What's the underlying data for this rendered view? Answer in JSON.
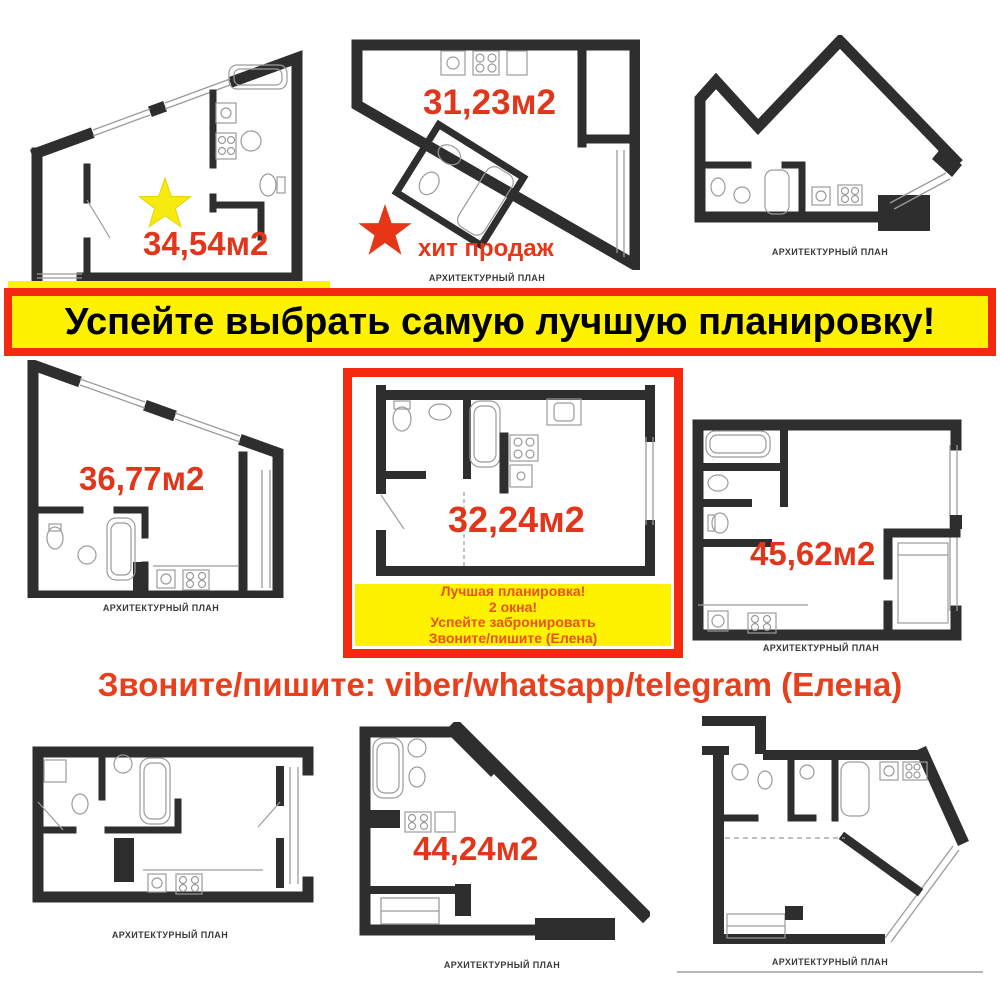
{
  "banner": {
    "text": "Успейте выбрать самую лучшую планировку!"
  },
  "contact": {
    "text": "Звоните/пишите: viber/whatsapp/telegram (Елена)"
  },
  "plans": [
    {
      "name": "top-left",
      "area": "34,54м2"
    },
    {
      "name": "top-middle",
      "area": "31,23м2",
      "badge": "хит продаж",
      "caption": "АРХИТЕКТУРНЫЙ ПЛАН"
    },
    {
      "name": "top-right",
      "caption": "АРХИТЕКТУРНЫЙ ПЛАН"
    },
    {
      "name": "middle-left",
      "area": "36,77м2",
      "caption": "АРХИТЕКТУРНЫЙ ПЛАН"
    },
    {
      "name": "middle-center",
      "area": "32,24м2",
      "promo": [
        "Лучшая планировка!",
        "2 окна!",
        "Успейте забронировать",
        "Звоните/пишите (Елена)"
      ]
    },
    {
      "name": "middle-right",
      "area": "45,62м2",
      "caption": "АРХИТЕКТУРНЫЙ ПЛАН"
    },
    {
      "name": "bottom-left",
      "caption": "АРХИТЕКТУРНЫЙ ПЛАН"
    },
    {
      "name": "bottom-middle",
      "area": "44,24м2",
      "caption": "АРХИТЕКТУРНЫЙ ПЛАН"
    },
    {
      "name": "bottom-right",
      "caption": "АРХИТЕКТУРНЫЙ ПЛАН"
    }
  ],
  "colors": {
    "accent_red": "#e2361c",
    "banner_yellow": "#fff200",
    "banner_border_red": "#f5290f",
    "wall_dark": "#2e2e2e",
    "star_yellow": "#f7ea10",
    "star_red": "#e63517",
    "promo_text_red": "#e8521c"
  }
}
